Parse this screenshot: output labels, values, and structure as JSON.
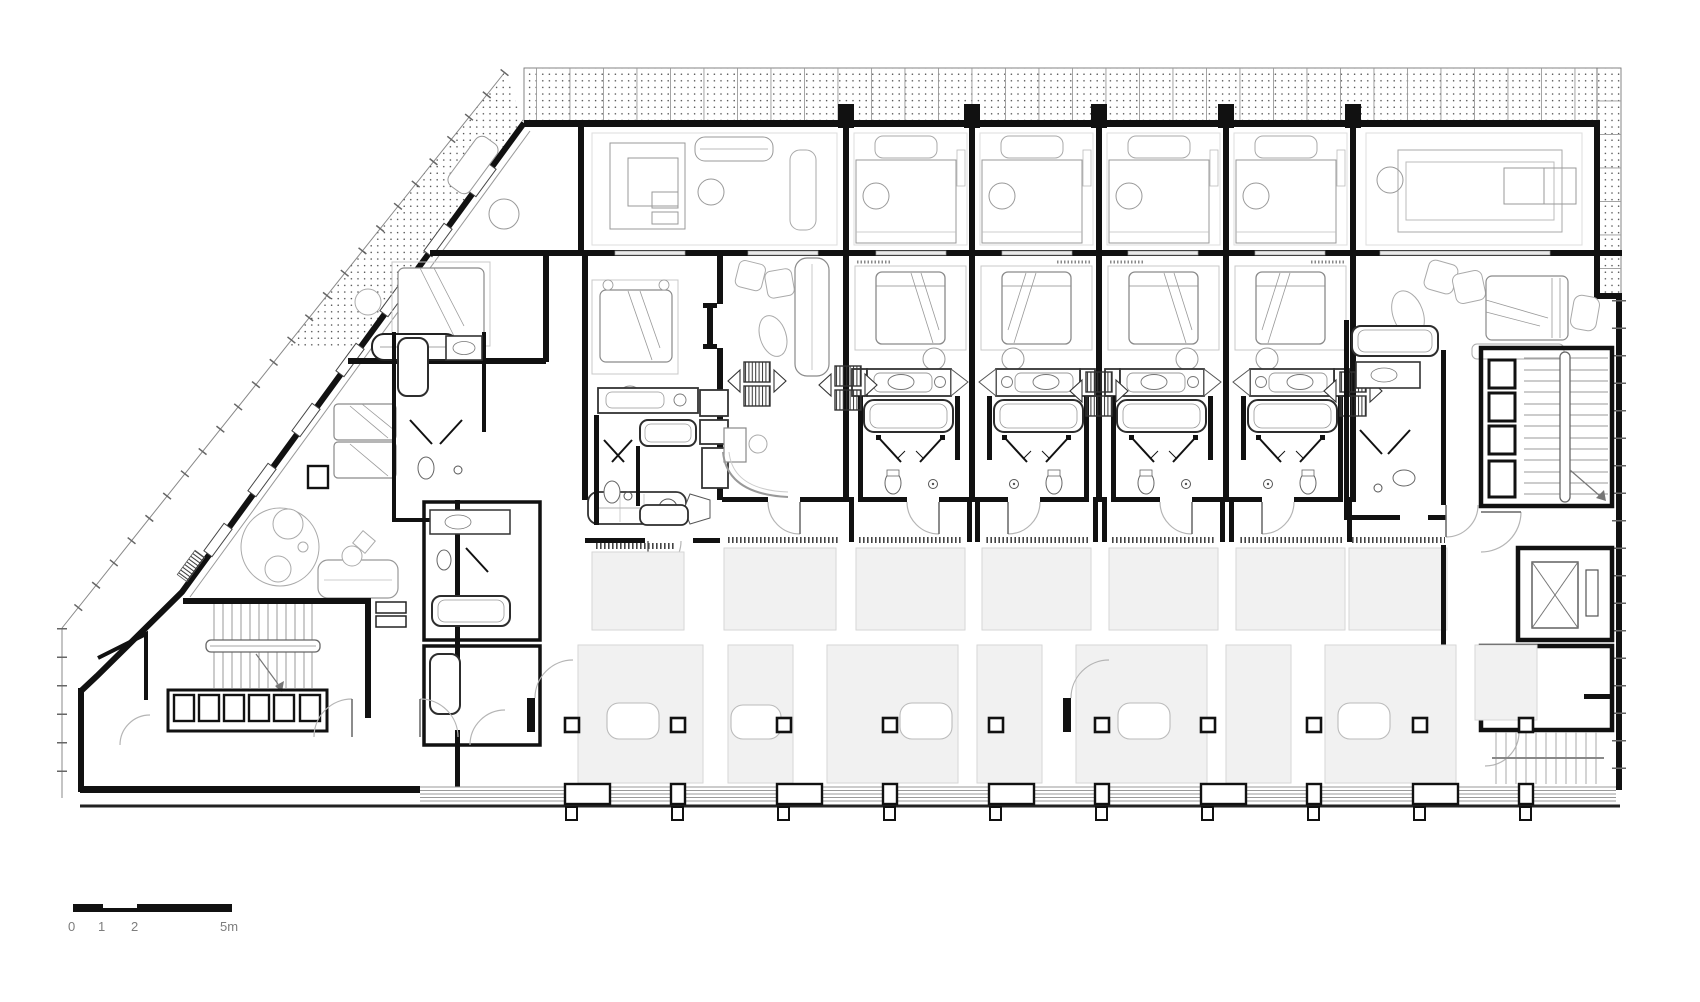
{
  "plan": {
    "type": "architectural-floor-plan",
    "subject": "hotel guest-room floor plan",
    "colors": {
      "wall": "#111111",
      "fixture_dark": "#2d2d2d",
      "furniture_mid": "#8a8a8a",
      "furniture_light": "#c8c8c8",
      "rug_fill": "#f1f1f1",
      "rug_border": "#d6d6d6",
      "terrace_dot": "#4a4a4a",
      "boundary_line": "#888888",
      "background": "#ffffff"
    },
    "elements": [
      "terrace-paving-band",
      "loggia-row",
      "guest-room-modules",
      "suite-left",
      "suite-center",
      "lounge-module",
      "suite-right",
      "service-shafts",
      "stair-left",
      "locker-row",
      "stair-core-right",
      "elevator",
      "lower-hall-rugs",
      "facade-columns",
      "glazed-facade",
      "scale-bar"
    ]
  },
  "scale_bar": {
    "ticks": [
      "0",
      "1",
      "2",
      "5m"
    ]
  }
}
